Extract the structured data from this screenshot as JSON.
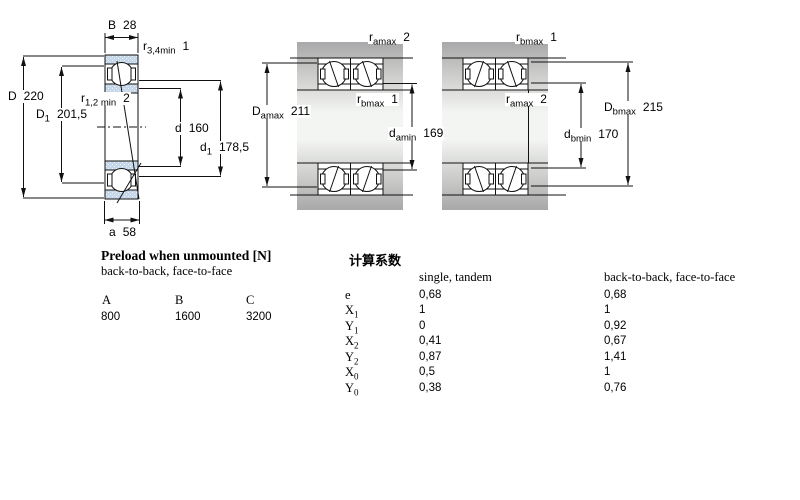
{
  "figures": {
    "single": {
      "dims": {
        "B": {
          "sym": "B",
          "sub": "",
          "val": "28"
        },
        "r34": {
          "sym": "r",
          "sub": "3,4min",
          "val": "1"
        },
        "D": {
          "sym": "D",
          "sub": "",
          "val": "220"
        },
        "D1": {
          "sym": "D",
          "sub": "1",
          "val": "201,5"
        },
        "r12": {
          "sym": "r",
          "sub": "1,2 min",
          "val": "2"
        },
        "d": {
          "sym": "d",
          "sub": "",
          "val": "160"
        },
        "d1": {
          "sym": "d",
          "sub": "1",
          "val": "178,5"
        },
        "a": {
          "sym": "a",
          "sub": "",
          "val": "58"
        }
      }
    },
    "tandem": {
      "dims": {
        "ra_top": {
          "sym": "r",
          "sub": "amax",
          "val": "2"
        },
        "Da": {
          "sym": "D",
          "sub": "amax",
          "val": "211"
        },
        "rb_mid": {
          "sym": "r",
          "sub": "bmax",
          "val": "1"
        },
        "da": {
          "sym": "d",
          "sub": "amin",
          "val": "169"
        }
      }
    },
    "paired": {
      "dims": {
        "rb_top": {
          "sym": "r",
          "sub": "bmax",
          "val": "1"
        },
        "ra_mid": {
          "sym": "r",
          "sub": "amax",
          "val": "2"
        },
        "Db": {
          "sym": "D",
          "sub": "bmax",
          "val": "215"
        },
        "db": {
          "sym": "d",
          "sub": "bmin",
          "val": "170"
        }
      }
    }
  },
  "preload": {
    "title": "Preload when unmounted [N]",
    "subtitle": "back-to-back, face-to-face",
    "columns": [
      "A",
      "B",
      "C"
    ],
    "values": [
      "800",
      "1600",
      "3200"
    ]
  },
  "factors": {
    "title": "计算系数",
    "col1_header": "single, tandem",
    "col2_header": "back-to-back, face-to-face",
    "rows": [
      {
        "sym": "e",
        "sub": "",
        "v1": "0,68",
        "v2": "0,68"
      },
      {
        "sym": "X",
        "sub": "1",
        "v1": "1",
        "v2": "1"
      },
      {
        "sym": "Y",
        "sub": "1",
        "v1": "0",
        "v2": "0,92"
      },
      {
        "sym": "X",
        "sub": "2",
        "v1": "0,41",
        "v2": "0,67"
      },
      {
        "sym": "Y",
        "sub": "2",
        "v1": "0,87",
        "v2": "1,41"
      },
      {
        "sym": "X",
        "sub": "0",
        "v1": "0,5",
        "v2": "1"
      },
      {
        "sym": "Y",
        "sub": "0",
        "v1": "0,38",
        "v2": "0,76"
      }
    ]
  },
  "colors": {
    "ring_fill": "#c7d7ea",
    "shaft_gray": "#a8a8aa",
    "line": "#111111"
  }
}
